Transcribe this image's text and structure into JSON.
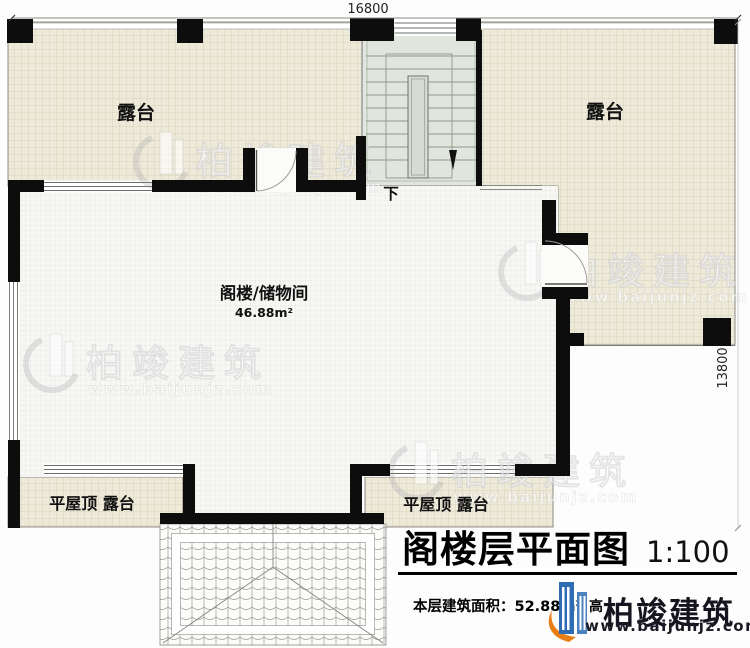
{
  "dimensions": {
    "top": "16800",
    "right": "13800"
  },
  "labels": {
    "terrace_left": "露台",
    "terrace_right": "露台",
    "room_name": "阁楼/储物间",
    "room_area": "46.88m²",
    "stairs_down": "下",
    "flat_roof_terrace_left": "平屋顶 露台",
    "flat_roof_terrace_right": "平屋顶 露台"
  },
  "title_block": {
    "title": "阁楼层平面图",
    "scale": "1:100",
    "area_label": "本层建筑面积：",
    "area_value": "52.88m²",
    "partial_text": "高",
    "brand_name": "柏竣建筑",
    "brand_url": "www.baijunjz.com"
  },
  "watermark": {
    "brand": "柏竣建筑",
    "url": "www.baijunjz.com"
  },
  "colors": {
    "terrace_fill": "#edeada",
    "terrace_grid": "#d9d3ba",
    "room_fill": "#f7f7f4",
    "room_grid": "#e9e9e5",
    "stair_fill": "#e0e5dd",
    "wall": "#0d0d0d",
    "brand_navy": "#15151f",
    "brand_blue": "#2e6db4",
    "brand_orange": "#e87f16"
  }
}
